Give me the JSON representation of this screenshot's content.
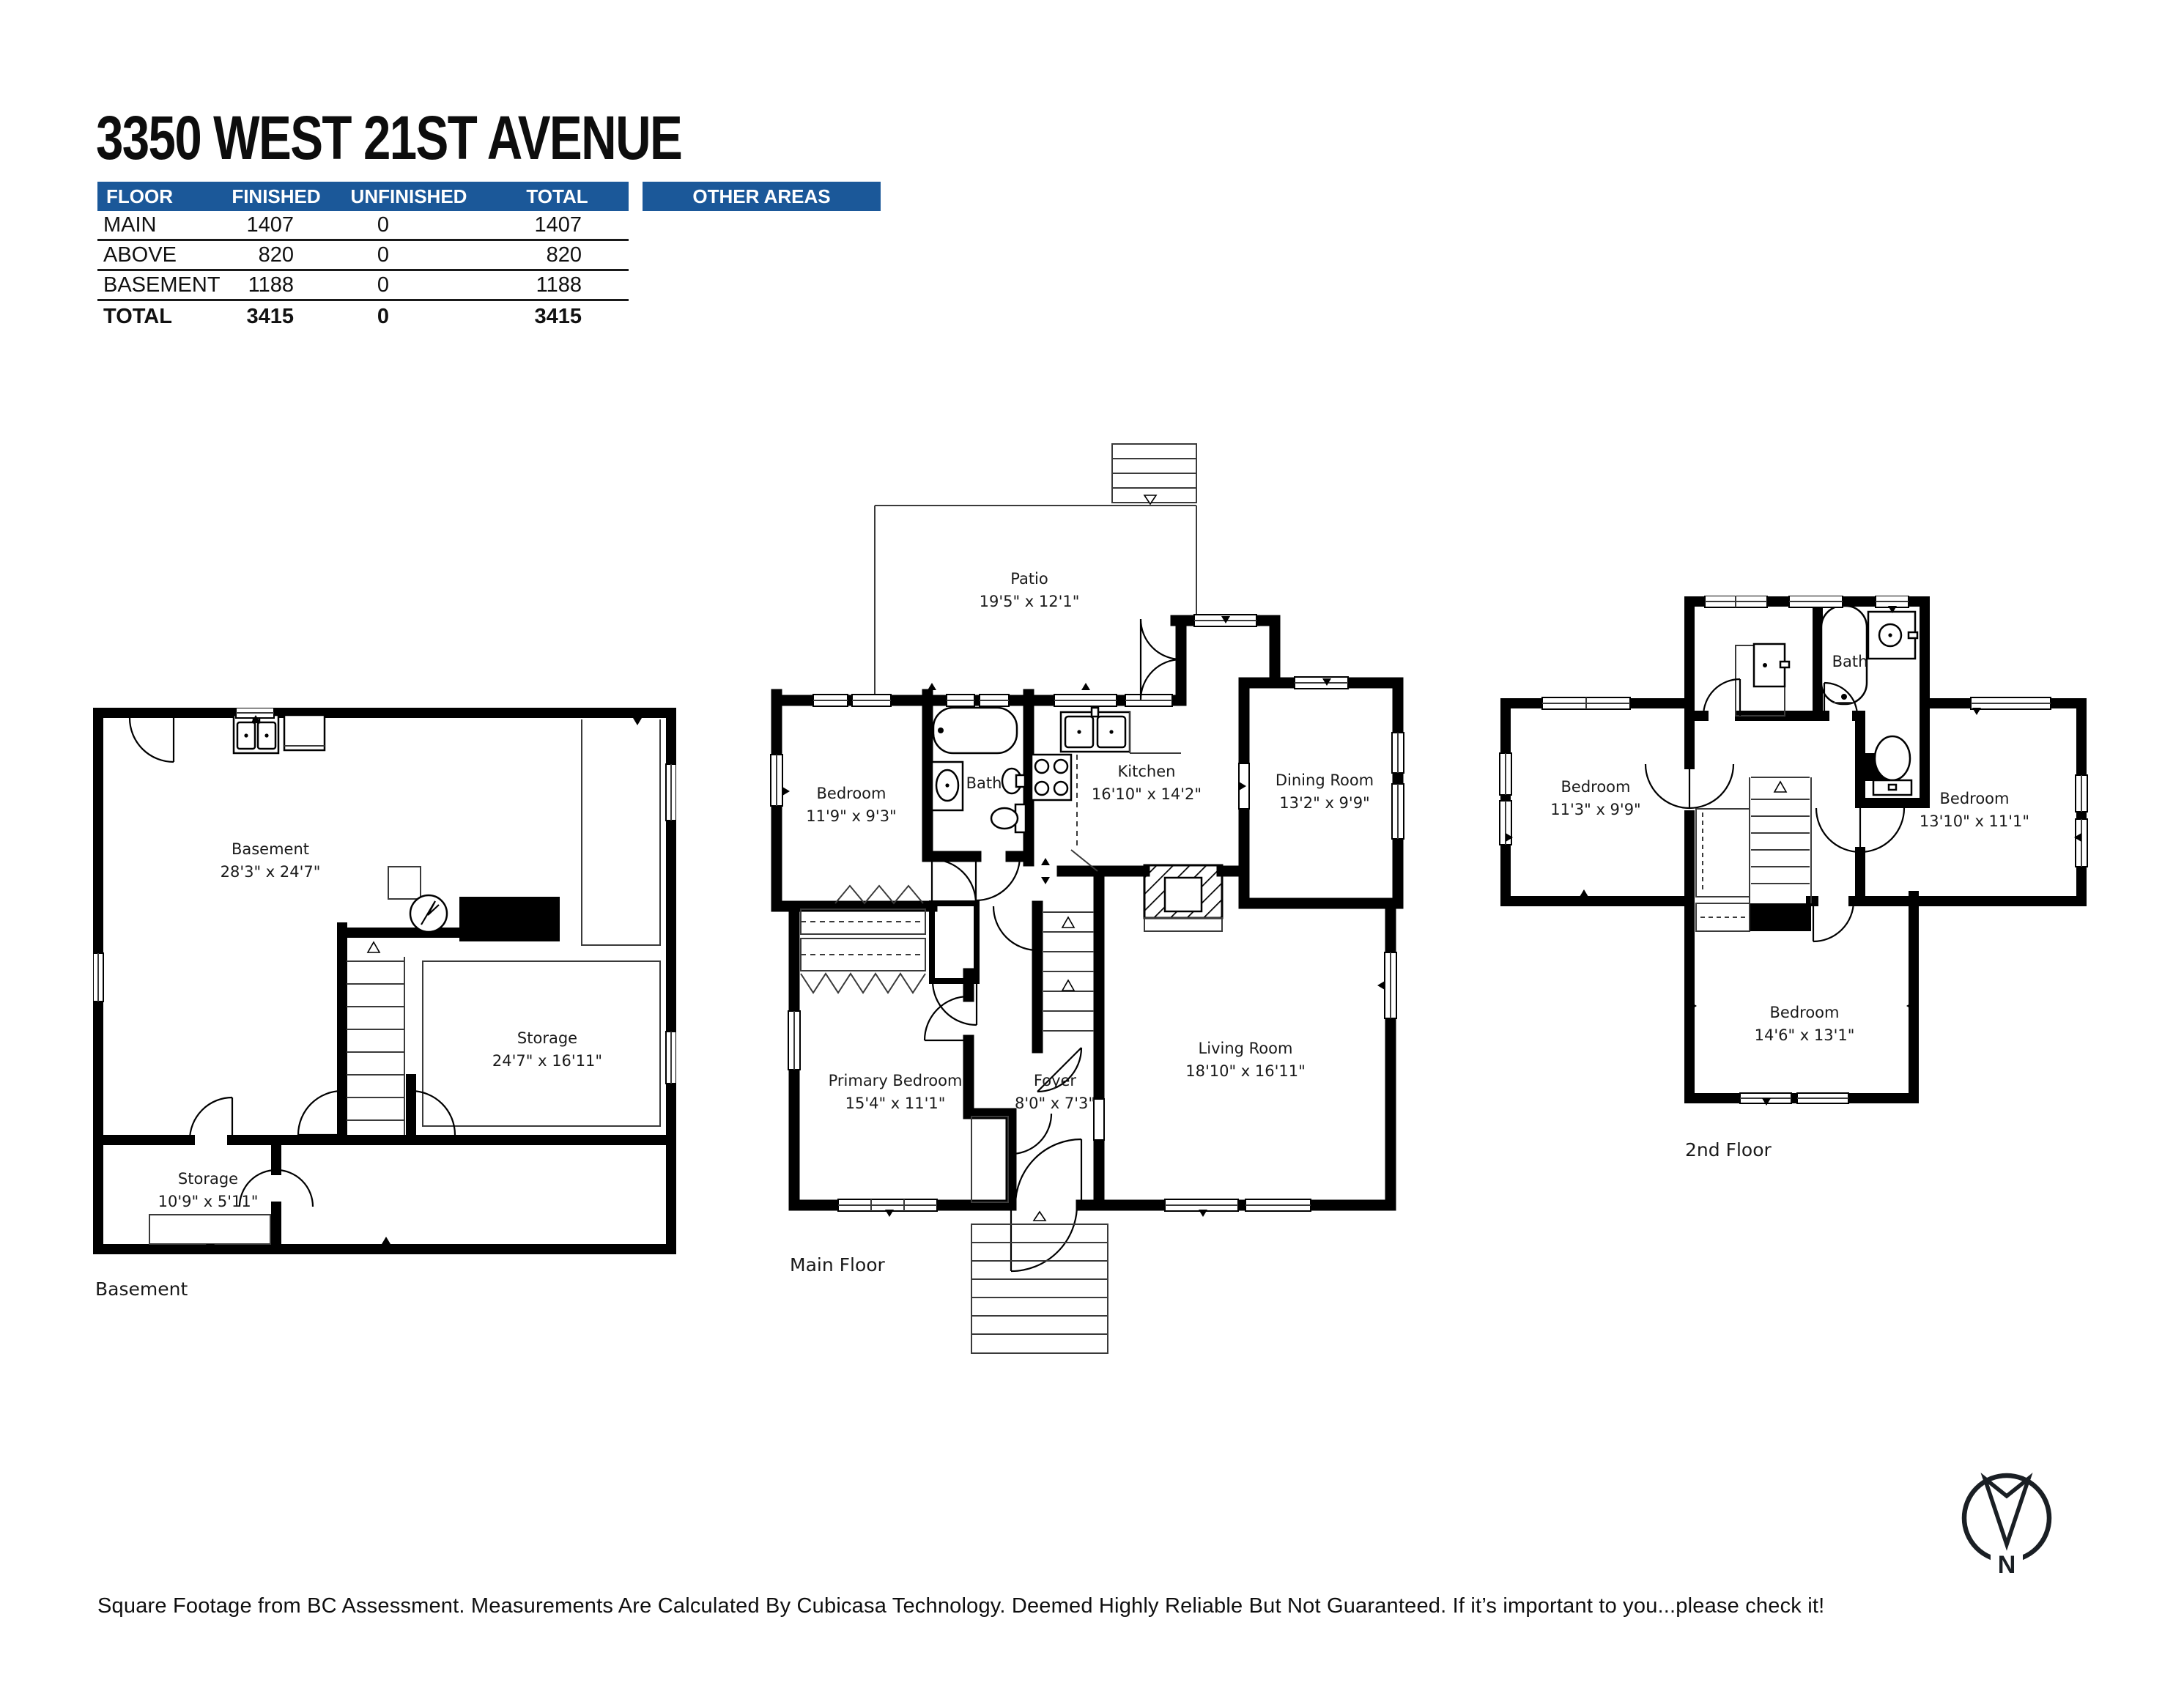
{
  "title": "3350 WEST 21ST AVENUE",
  "colors": {
    "header_blue": "#1b5899",
    "wall_black": "#000000"
  },
  "area_table": {
    "headers": [
      "FLOOR",
      "FINISHED",
      "UNFINISHED",
      "TOTAL"
    ],
    "rows": [
      {
        "floor": "MAIN",
        "finished": "1407",
        "unfinished": "0",
        "total": "1407"
      },
      {
        "floor": "ABOVE",
        "finished": "820",
        "unfinished": "0",
        "total": "820"
      },
      {
        "floor": "BASEMENT",
        "finished": "1188",
        "unfinished": "0",
        "total": "1188"
      }
    ],
    "total_row": {
      "floor": "TOTAL",
      "finished": "3415",
      "unfinished": "0",
      "total": "3415"
    }
  },
  "other_areas_label": "OTHER AREAS",
  "floors": {
    "basement": {
      "label": "Basement",
      "rooms": [
        {
          "name": "Basement",
          "dims": "28'3\" x 24'7\""
        },
        {
          "name": "Storage",
          "dims": "24'7\" x 16'11\""
        },
        {
          "name": "Storage",
          "dims": "10'9\" x 5'11\""
        }
      ]
    },
    "main": {
      "label": "Main Floor",
      "rooms": [
        {
          "name": "Patio",
          "dims": "19'5\" x 12'1\""
        },
        {
          "name": "Bedroom",
          "dims": "11'9\" x 9'3\""
        },
        {
          "name": "Bath",
          "dims": ""
        },
        {
          "name": "Kitchen",
          "dims": "16'10\" x 14'2\""
        },
        {
          "name": "Dining Room",
          "dims": "13'2\" x 9'9\""
        },
        {
          "name": "Living Room",
          "dims": "18'10\" x 16'11\""
        },
        {
          "name": "Primary Bedroom",
          "dims": "15'4\" x 11'1\""
        },
        {
          "name": "Foyer",
          "dims": "8'0\" x 7'3\""
        }
      ]
    },
    "second": {
      "label": "2nd Floor",
      "rooms": [
        {
          "name": "Bath",
          "dims": ""
        },
        {
          "name": "Bedroom",
          "dims": "11'3\" x 9'9\""
        },
        {
          "name": "Bedroom",
          "dims": "13'10\" x 11'1\""
        },
        {
          "name": "Bedroom",
          "dims": "14'6\" x 13'1\""
        }
      ]
    }
  },
  "compass": {
    "letter": "N"
  },
  "footer": "Square Footage from BC Assessment. Measurements Are Calculated By Cubicasa Technology. Deemed Highly Reliable But Not Guaranteed. If it’s important to you...please check it!"
}
